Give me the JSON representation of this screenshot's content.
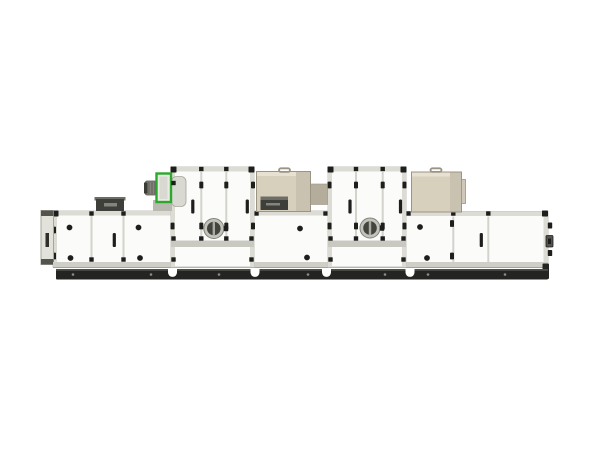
{
  "scene": {
    "background": "#ffffff",
    "description": "Side view of a long modular air handling / desiccant dehumidifier unit on a white background"
  },
  "colors": {
    "background": "#ffffff",
    "panel": "#fbfbf9",
    "panelEdge": "#c6c6bf",
    "frame": "#dcdcd5",
    "midband": "#c9c9c2",
    "seam": "#d3d3cc",
    "sill": "#cfcfc8",
    "sillEdge": "#a3a39c",
    "dark": "#1e1e1c",
    "plinth": "#242422",
    "plinthTop": "#4e4e49",
    "plinthDot": "#8b8b84",
    "beige": "#d7d0bd",
    "beigeTop": "#e7e1d2",
    "beigeSide": "#c9c2b0",
    "beigeDark": "#b5ad9b",
    "beigeTab": "#cfc8b6",
    "beigeOutline": "#9b9485",
    "green": "#2ca82c",
    "greenFill": "#eaeae5",
    "motor": "#84847d",
    "motorDark": "#55554f",
    "motorCap": "#3a3a36",
    "scroll": "#d9d9d2",
    "scrollEdge": "#a6a69f",
    "bracket": "#b9b9b2",
    "vent": "#3e3e3a",
    "ventTop": "#6d6d65",
    "ventLight": "#84847c",
    "portRing": "#c3c3bc",
    "portRingEdge": "#82827b",
    "portGlass": "#44443f",
    "portSlit": "#aaaaa2",
    "flange": "#e2e2db",
    "flangeCap": "#54544e",
    "flangeSlot": "#2e2e2a"
  },
  "machine": {
    "name": "modular-air-handling-unit",
    "modules": [
      {
        "name": "inlet-damper-flange"
      },
      {
        "name": "filter-section"
      },
      {
        "name": "supply-blower"
      },
      {
        "name": "rotor-access-tower-left"
      },
      {
        "name": "regeneration-section"
      },
      {
        "name": "rotor-access-tower-right"
      },
      {
        "name": "discharge-section"
      },
      {
        "name": "base-plinth"
      }
    ]
  }
}
